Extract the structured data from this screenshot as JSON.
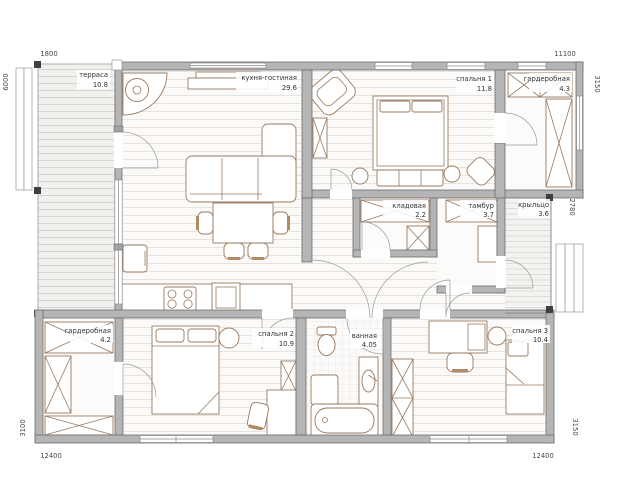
{
  "plan": {
    "rooms": {
      "terrace": {
        "name": "терраса",
        "area": "10.8"
      },
      "kitchen_living": {
        "name": "кухня-гостиная",
        "area": "29.6"
      },
      "bedroom1": {
        "name": "спальня 1",
        "area": "11.8"
      },
      "wardrobe_top": {
        "name": "гардеробная",
        "area": "4.3"
      },
      "storage": {
        "name": "кладовая",
        "area": "2.2"
      },
      "vestibule": {
        "name": "тамбур",
        "area": "3.7"
      },
      "porch": {
        "name": "крыльцо",
        "area": "3.6"
      },
      "wardrobe_bottom": {
        "name": "гардеробная",
        "area": "4.2"
      },
      "bedroom2": {
        "name": "спальня 2",
        "area": "10.9"
      },
      "bathroom": {
        "name": "ванная",
        "area": "4.05"
      },
      "bedroom3": {
        "name": "спальня 3",
        "area": "10.4"
      }
    },
    "dimensions": {
      "top_terrace": "1800",
      "top_main": "11100",
      "left_upper": "6000",
      "left_lower": "3100",
      "right_upper": "3150",
      "right_middle": "2780",
      "right_lower": "3150",
      "bottom_left": "12400",
      "bottom_right": "12400"
    },
    "colors": {
      "wall": "#b5b5b5",
      "wall_stroke": "#6f6f6f",
      "furniture": "#9a7a60",
      "label": "#333333",
      "dimension": "#4a4a4a"
    }
  }
}
